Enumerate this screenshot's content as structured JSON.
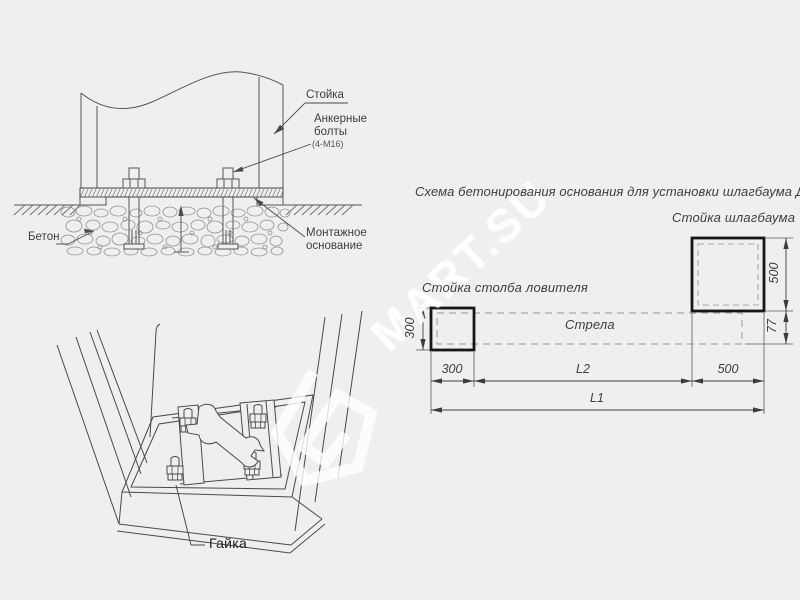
{
  "watermark": {
    "text": "MART.SU"
  },
  "section_view": {
    "post_label": "Стойка",
    "anchor_bolts_label": "Анкерные болты",
    "anchor_bolts_spec": "(4-М16)",
    "concrete_label": "Бетон",
    "mounting_base_label": "Монтажное основание"
  },
  "pit_view": {
    "nut_label": "Гайка"
  },
  "plan_view": {
    "title": "Схема бетонирования основания для установки шлагбаума ДорХан",
    "barrier_post_label": "Стойка шлагбаума",
    "catcher_post_label": "Стойка столба ловителя",
    "boom_label": "Стрела",
    "dim_post_height": "300",
    "dim_post_width": "300",
    "dim_l2": "L2",
    "dim_base_width": "500",
    "dim_base_height": "500",
    "dim_boom_offset": "77",
    "dim_l1": "L1"
  }
}
